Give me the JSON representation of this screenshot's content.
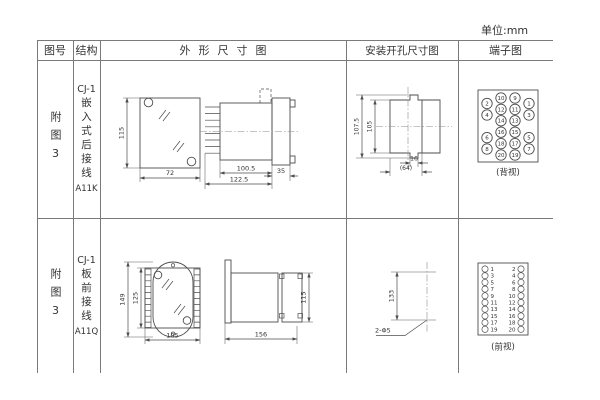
{
  "unit_label": "单位:mm",
  "headers": {
    "fig_no": "图号",
    "structure": "结构",
    "outline": "外形尺寸图",
    "mounting": "安装开孔尺寸图",
    "terminal": "端子图"
  },
  "rows": [
    {
      "fig_no": "附图3",
      "structure": {
        "model": "CJ-1",
        "desc": "嵌入式后接线",
        "code": "A11K"
      },
      "outline_dims": {
        "front_height": "115",
        "front_width": "72",
        "side_body": "100.5",
        "side_total": "122.5",
        "side_flange": "35"
      },
      "mounting_dims": {
        "outer_h": "107.5",
        "inner_h": "105",
        "notch_w": "16",
        "total_w": "(64)"
      },
      "terminals": {
        "outer_left": [
          "2",
          "4",
          "6",
          "8"
        ],
        "inner_left": [
          "10",
          "12",
          "14",
          "16",
          "18",
          "20"
        ],
        "inner_right": [
          "9",
          "11",
          "13",
          "15",
          "17",
          "19"
        ],
        "outer_right": [
          "1",
          "3",
          "5",
          "7"
        ],
        "view_label": "(背视)"
      }
    },
    {
      "fig_no": "附图3",
      "structure": {
        "model": "CJ-1",
        "desc": "板前接线",
        "code": "A11Q"
      },
      "outline_dims": {
        "front_outer_h": "149",
        "front_inner_h": "125",
        "front_width": "105",
        "side_length": "156",
        "side_height": "115"
      },
      "mounting_dims": {
        "hole_spacing": "133",
        "holes_label": "2-Φ5"
      },
      "terminals": {
        "left": [
          "1",
          "3",
          "5",
          "7",
          "9",
          "11",
          "13",
          "15",
          "17",
          "19"
        ],
        "right": [
          "2",
          "4",
          "6",
          "8",
          "10",
          "12",
          "14",
          "16",
          "18",
          "20"
        ],
        "view_label": "(前视)"
      }
    }
  ]
}
